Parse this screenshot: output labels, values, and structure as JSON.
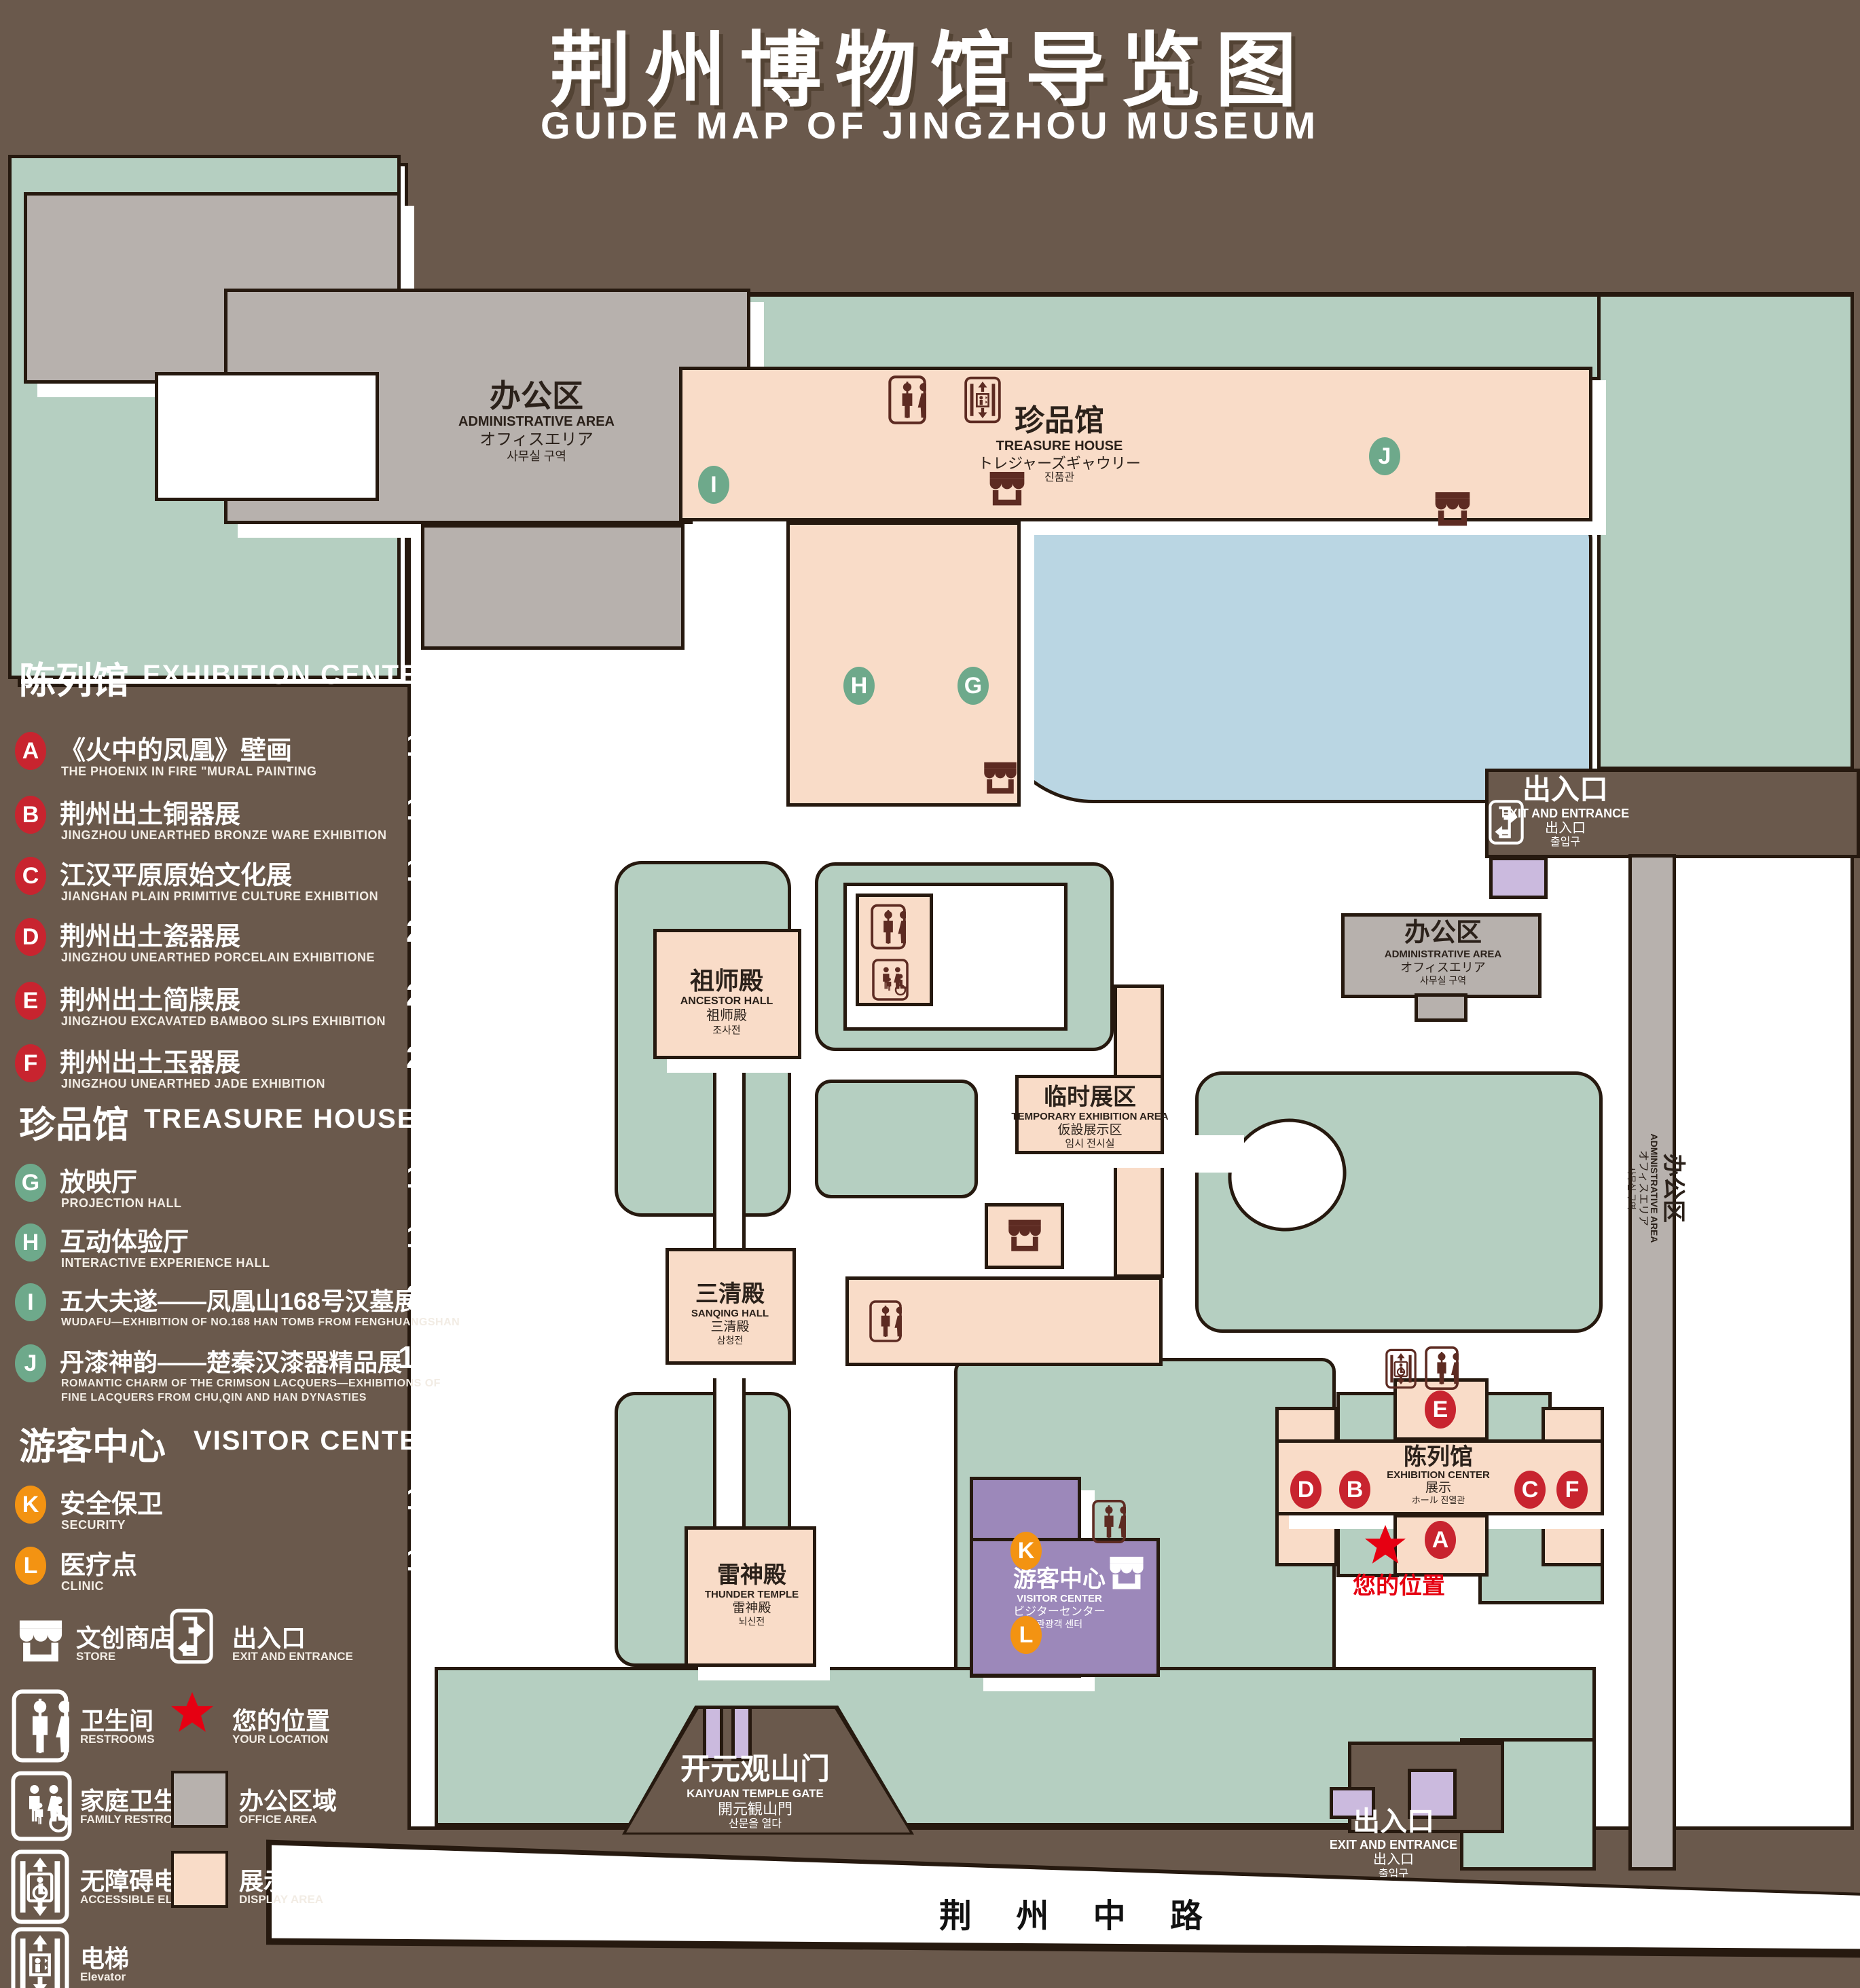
{
  "title": {
    "zh": "荆州博物馆导览图",
    "en": "GUIDE MAP OF JINGZHOU MUSEUM"
  },
  "colors": {
    "background": "#6a594c",
    "map_green": "#b5cfc1",
    "display_pink": "#f9dcc8",
    "office_gray": "#b7b1ad",
    "pond_blue": "#bad6e3",
    "visitor_purple": "#9c88ba",
    "lavender": "#cbbade",
    "badge_red": "#c8242f",
    "badge_green": "#6ea98b",
    "badge_orange": "#f39312",
    "location_red": "#e60012",
    "icon_maroon": "#5d2b22"
  },
  "legend": {
    "sections": [
      {
        "zh": "陈列馆",
        "en": "EXHIBITION CENTER",
        "items": [
          {
            "key": "A",
            "zh": "《火中的凤凰》壁画",
            "en": "THE PHOENIX IN FIRE \"MURAL PAINTING",
            "floor": "1F"
          },
          {
            "key": "B",
            "zh": "荆州出土铜器展",
            "en": "JINGZHOU UNEARTHED BRONZE WARE EXHIBITION",
            "floor": "1F"
          },
          {
            "key": "C",
            "zh": "江汉平原原始文化展",
            "en": "JIANGHAN PLAIN PRIMITIVE CULTURE EXHIBITION",
            "floor": "1F"
          },
          {
            "key": "D",
            "zh": "荆州出土瓷器展",
            "en": "JINGZHOU UNEARTHED PORCELAIN EXHIBITIONE",
            "floor": "2F"
          },
          {
            "key": "E",
            "zh": "荆州出土简牍展",
            "en": "JINGZHOU EXCAVATED BAMBOO SLIPS EXHIBITION",
            "floor": "2F"
          },
          {
            "key": "F",
            "zh": "荆州出土玉器展",
            "en": "JINGZHOU UNEARTHED JADE EXHIBITION",
            "floor": "2F"
          }
        ]
      },
      {
        "zh": "珍品馆",
        "en": "TREASURE HOUSE",
        "items": [
          {
            "key": "G",
            "zh": "放映厅",
            "en": "PROJECTION HALL",
            "floor": "1F"
          },
          {
            "key": "H",
            "zh": "互动体验厅",
            "en": "INTERACTIVE EXPERIENCE HALL",
            "floor": "1F"
          },
          {
            "key": "I",
            "zh": "五大夫遂——凤凰山168号汉墓展",
            "en": "WUDAFU—EXHIBITION OF NO.168 HAN TOMB FROM FENGHUANGSHAN",
            "floor": "2F"
          },
          {
            "key": "J",
            "zh": "丹漆神韵——楚秦汉漆器精品展",
            "en": "ROMANTIC CHARM OF THE CRIMSON LACQUERS—EXHIBITIONS OF FINE LACQUERS FROM CHU,QIN AND HAN DYNASTIES",
            "floor": "1-2F"
          }
        ]
      },
      {
        "zh": "游客中心",
        "en": "VISITOR CENTER",
        "items": [
          {
            "key": "K",
            "zh": "安全保卫",
            "en": "SECURITY",
            "floor": "1F"
          },
          {
            "key": "L",
            "zh": "医疗点",
            "en": "CLINIC",
            "floor": "1F"
          }
        ]
      }
    ],
    "symbols": [
      {
        "icon": "store-icon",
        "zh": "文创商店",
        "en": "STORE"
      },
      {
        "icon": "exit-icon",
        "zh": "出入口",
        "en": "EXIT AND ENTRANCE"
      },
      {
        "icon": "restrooms-icon",
        "zh": "卫生间",
        "en": "RESTROOMS"
      },
      {
        "icon": "your-location-star",
        "zh": "您的位置",
        "en": "YOUR LOCATION"
      },
      {
        "icon": "family-restrooms-icon",
        "zh": "家庭卫生间",
        "en": "FAMILY RESTROOMS"
      },
      {
        "icon": "office-area-swatch",
        "zh": "办公区域",
        "en": "OFFICE AREA"
      },
      {
        "icon": "accessible-elevator-icon",
        "zh": "无障碍电梯",
        "en": "ACCESSIBLE ELEVATOR"
      },
      {
        "icon": "display-area-swatch",
        "zh": "展示区域",
        "en": "DISPLAY AREA"
      },
      {
        "icon": "elevator-icon",
        "zh": "电梯",
        "en": "Elevator"
      }
    ]
  },
  "map": {
    "admin": {
      "zh": "办公区",
      "en": "ADMINISTRATIVE AREA",
      "jp": "オフィスエリア",
      "kr": "사무실 구역"
    },
    "treasure": {
      "zh": "珍品馆",
      "en": "TREASURE HOUSE",
      "jp": "トレジャーズギャウリー",
      "kr": "진품관"
    },
    "ancestor": {
      "zh": "祖师殿",
      "en": "ANCESTOR HALL",
      "jp": "祖师殿",
      "kr": "조사전"
    },
    "temporary": {
      "zh": "临时展区",
      "en": "TEMPORARY EXHIBITION AREA",
      "jp": "仮設展示区",
      "kr": "임시 전시실"
    },
    "sanqing": {
      "zh": "三清殿",
      "en": "SANQING HALL",
      "jp": "三清殿",
      "kr": "삼청전"
    },
    "thunder": {
      "zh": "雷神殿",
      "en": "THUNDER TEMPLE",
      "jp": "雷神殿",
      "kr": "뇌신전"
    },
    "visitor": {
      "zh": "游客中心",
      "en": "VISITOR CENTER",
      "jp": "ビジターセンター",
      "kr": "관광객 센터"
    },
    "exhibition": {
      "zh": "陈列馆",
      "en": "EXHIBITION CENTER",
      "jp": "展示",
      "kr": "ホール 진열관"
    },
    "exit": {
      "zh": "出入口",
      "en": "EXIT AND ENTRANCE",
      "jp": "出入口",
      "kr": "출입구"
    },
    "gate": {
      "zh": "开元观山门",
      "en": "KAIYUAN TEMPLE GATE",
      "jp": "開元観山門",
      "kr": "산문을 열다"
    },
    "road": "荆 州 中 路",
    "your_location": "您的位置"
  }
}
